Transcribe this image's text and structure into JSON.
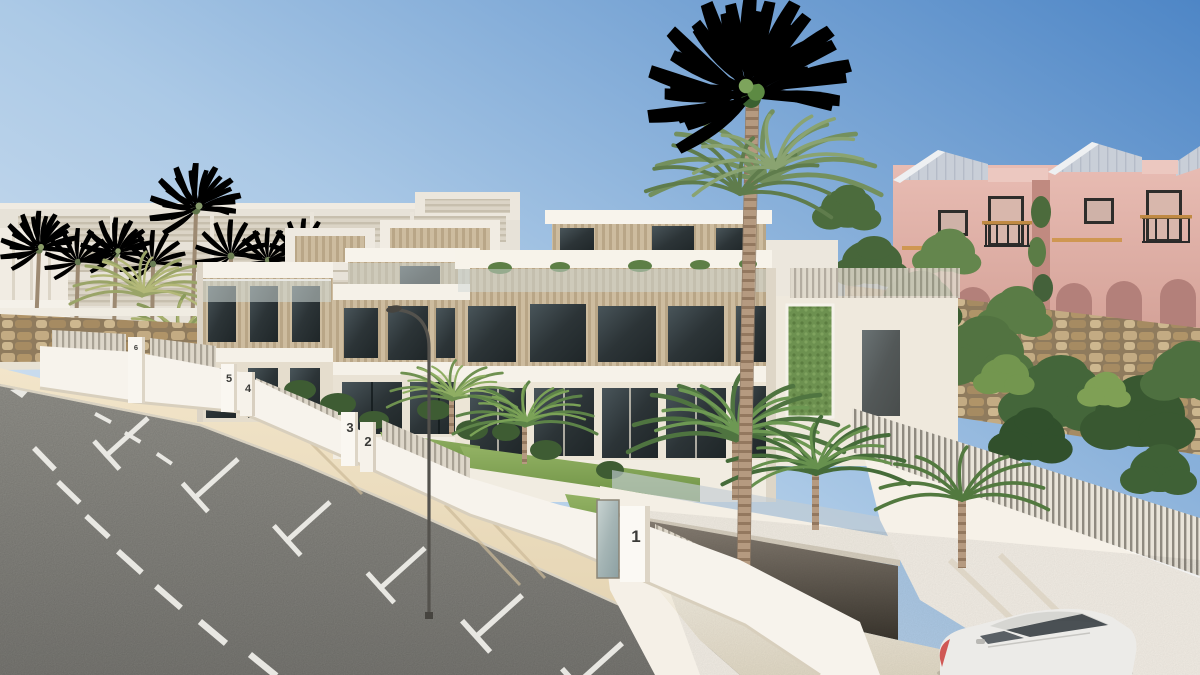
{
  "scene": {
    "title": "New-build townhouse development street render",
    "setting": "Modern white three-storey townhouses with wood louvers and glass balustrades along a curved downhill street with roadside parking bays, palm trees, numbered plot pillars, a basement garage ramp with a white car, and pink townhouses on a stone-walled green hillside behind",
    "sky": {
      "deep": "#4e86c6",
      "pale": "#d9e6f3"
    },
    "road": {
      "asphalt": "#8f8e89",
      "markings": "#efeee9",
      "sidewalk": "#ecdcbd"
    },
    "materials": {
      "townhouse_white": "#f3eee5",
      "louver_wood": "#c9b89b",
      "glass_dark": "#394246",
      "pink_house": "#e2b3ab",
      "pink_roof": "#c9cfd8",
      "stone_wall": "#b09671",
      "green_wall": "#6d9150",
      "foliage_dark": "#3f5e33",
      "foliage_light": "#7fa055",
      "lawn": "#84a755"
    },
    "plot_markers": [
      {
        "label": "6"
      },
      {
        "label": "5"
      },
      {
        "label": "4"
      },
      {
        "label": "3"
      },
      {
        "label": "2"
      },
      {
        "label": "1"
      }
    ],
    "vehicles": [
      {
        "type": "white car",
        "position": "bottom right on garage ramp"
      }
    ]
  }
}
